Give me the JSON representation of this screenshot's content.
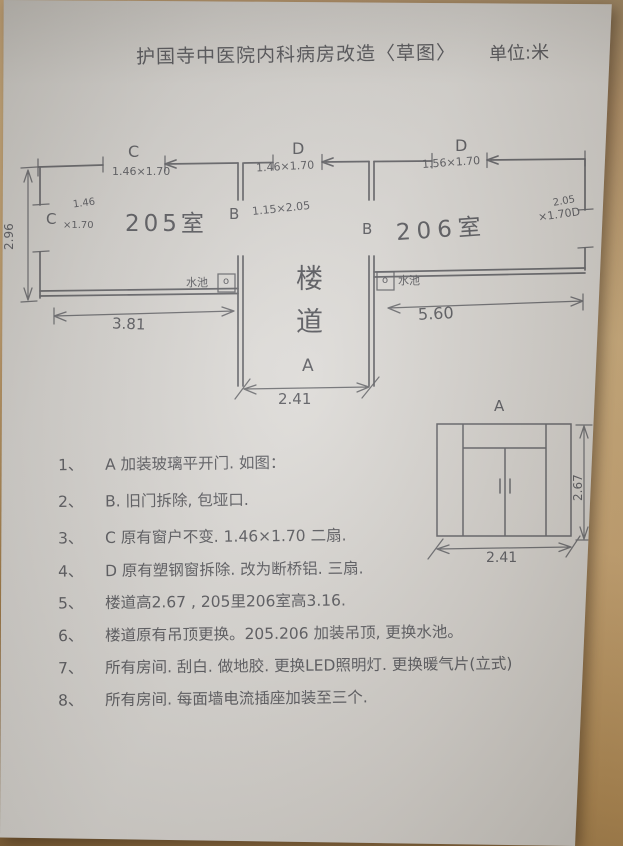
{
  "title": "护国寺中医院内科病房改造〈草图〉",
  "unit": "单位:米",
  "plan": {
    "window_c_top": {
      "letter": "C",
      "size": "1.46×1.70"
    },
    "window_d_mid": {
      "letter": "D",
      "size": "1.46×1.70"
    },
    "window_d_right": {
      "letter": "D",
      "size": "1.56×1.70"
    },
    "window_c_left": {
      "letter": "C",
      "width": "1.46",
      "height": "×1.70"
    },
    "window_d_east": {
      "width": "2.05",
      "size": "×1.70D"
    },
    "door_b_left": {
      "letter": "B",
      "size": "1.15×2.05"
    },
    "door_b_right": {
      "letter": "B"
    },
    "room_205": "205室",
    "room_206": "206室",
    "corridor": "楼道",
    "door_a_label": "A",
    "sink_label_left": "水池",
    "sink_label_right": "水池",
    "sink_mark_left": "o",
    "sink_mark_right": "o",
    "dim_room205_width": "3.81",
    "dim_room206_width": "5.60",
    "dim_corridor_width": "2.41",
    "dim_room_depth": "2.96"
  },
  "detail": {
    "label": "A",
    "dim_width": "2.41",
    "dim_height": "2.67"
  },
  "notes": [
    {
      "num": "1、",
      "text": "A 加装玻璃平开门. 如图："
    },
    {
      "num": "2、",
      "text": "B. 旧门拆除, 包垭口."
    },
    {
      "num": "3、",
      "text": "C 原有窗户不变. 1.46×1.70 二扇."
    },
    {
      "num": "4、",
      "text": "D 原有塑钢窗拆除. 改为断桥铝. 三扇."
    },
    {
      "num": "5、",
      "text": "楼道高2.67 , 205里206室高3.16."
    },
    {
      "num": "6、",
      "text": "楼道原有吊顶更换。205.206 加装吊顶, 更换水池。"
    },
    {
      "num": "7、",
      "text": "所有房间. 刮白. 做地胶. 更换LED照明灯. 更换暖气片(立式)"
    },
    {
      "num": "8、",
      "text": "所有房间. 每面墙电流插座加装至三个."
    }
  ]
}
